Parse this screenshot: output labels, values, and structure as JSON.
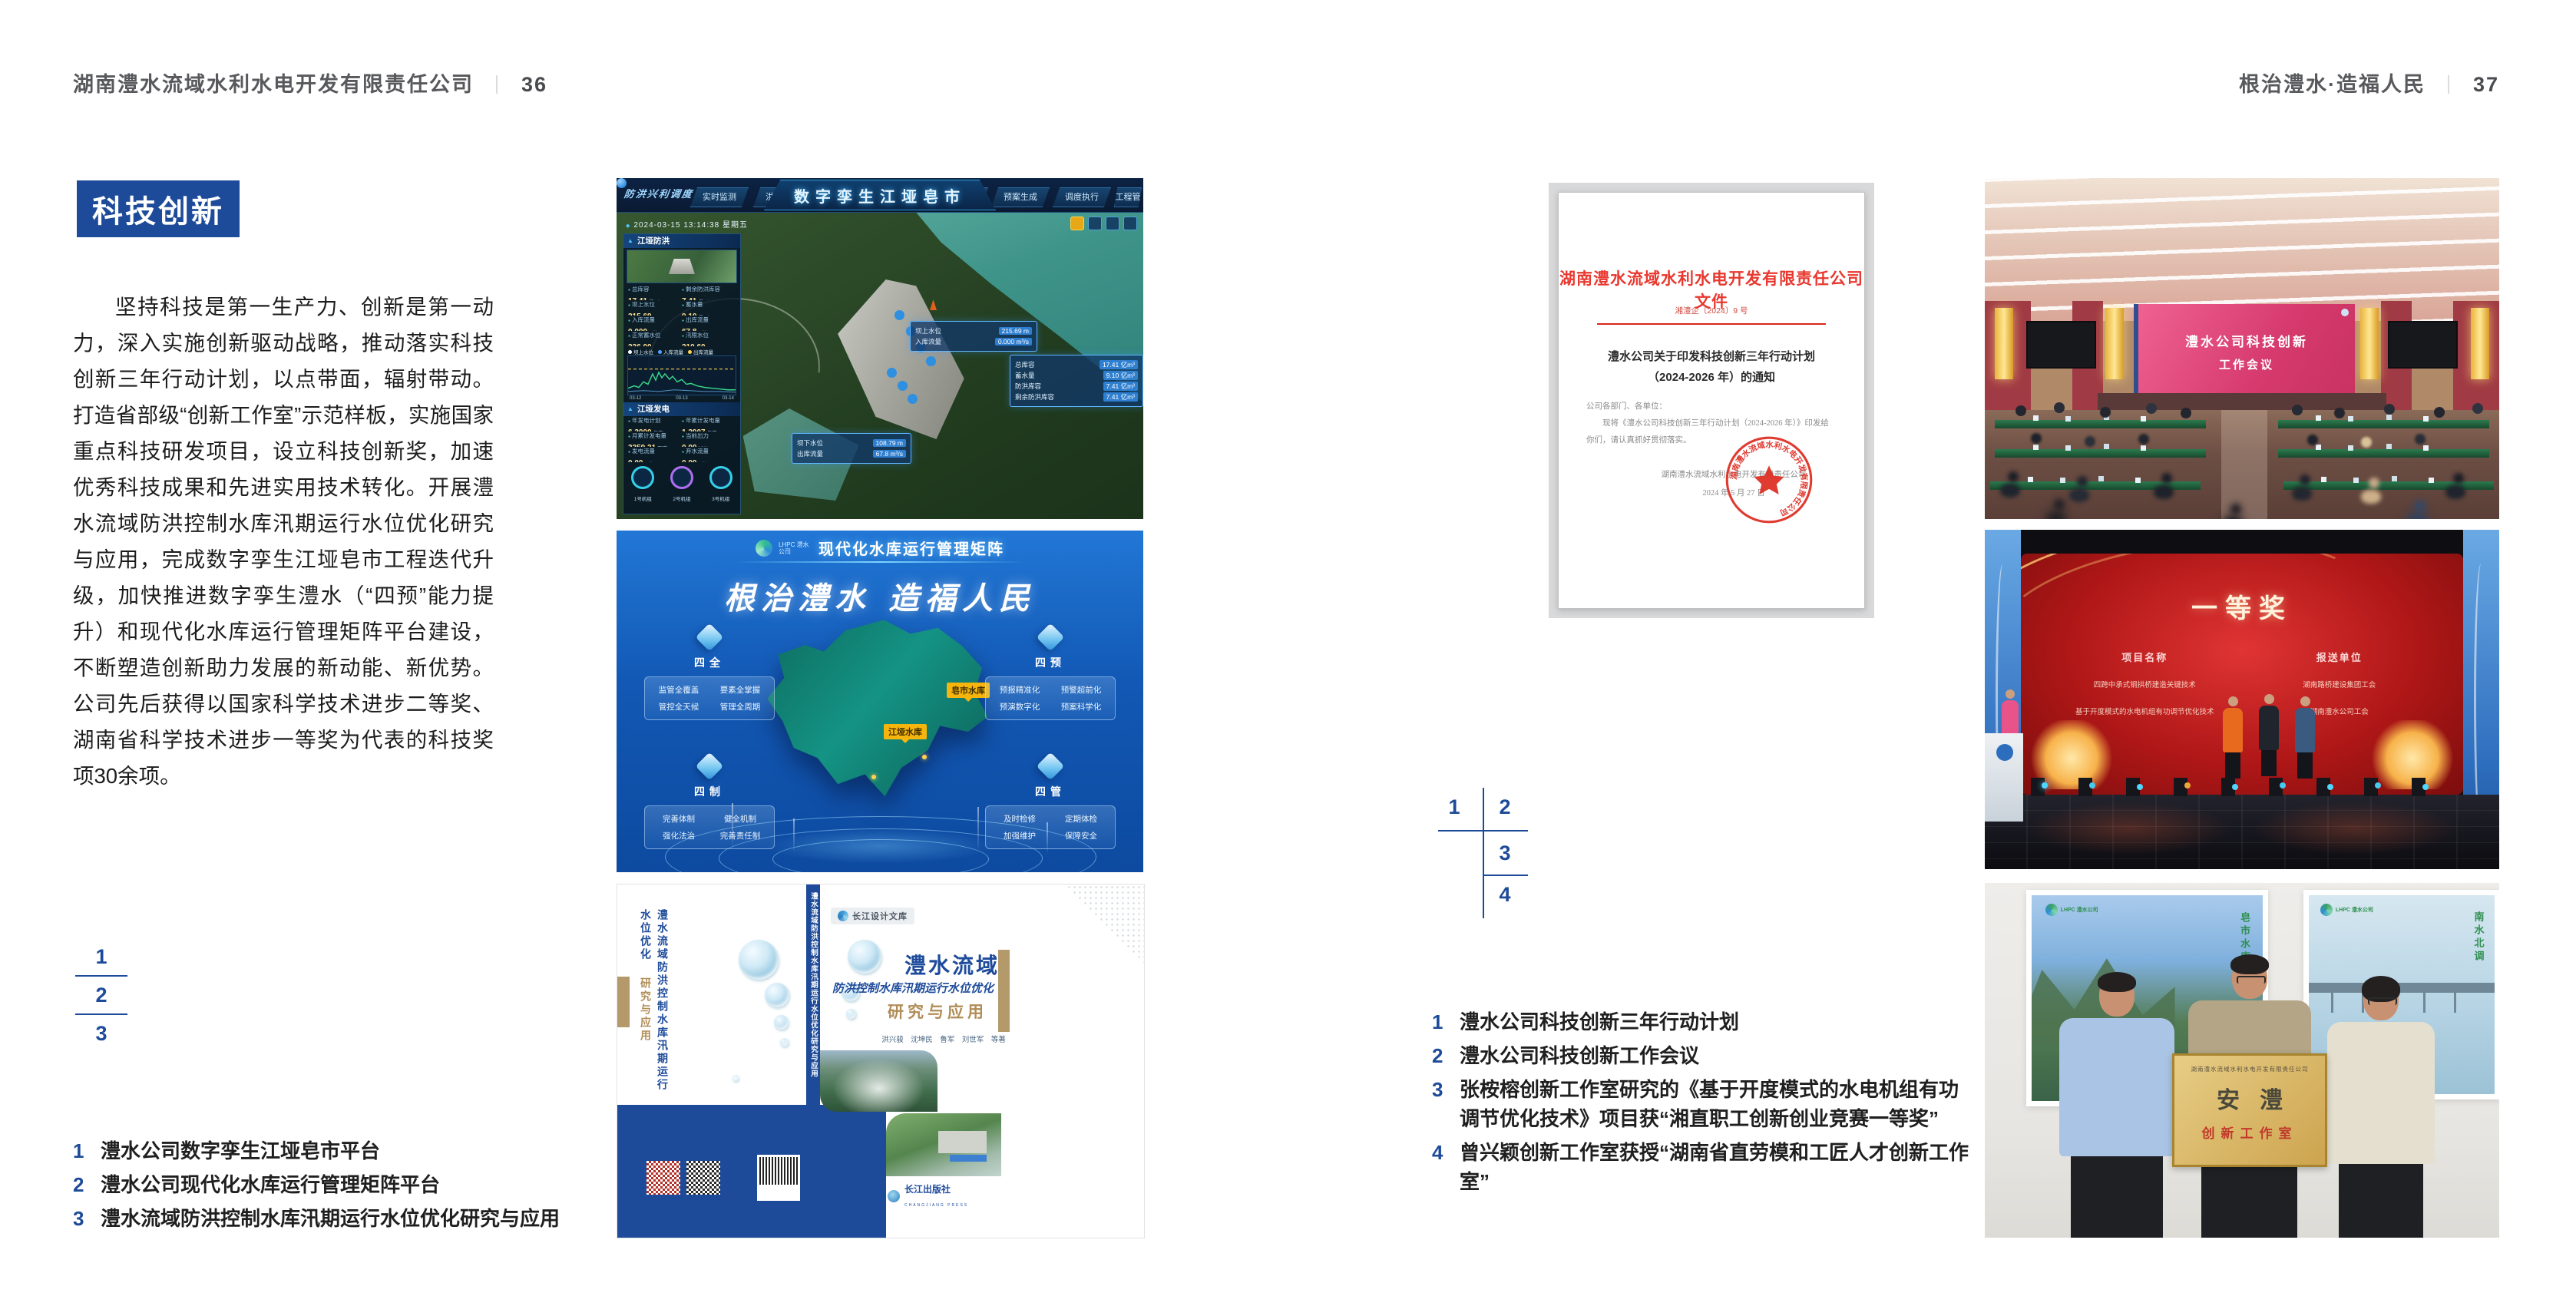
{
  "left_page": {
    "header": {
      "company": "湖南澧水流域水利水电开发有限责任公司",
      "divider": "｜",
      "page_no": "36"
    },
    "section_title": "科技创新",
    "body": "坚持科技是第一生产力、创新是第一动力，深入实施创新驱动战略，推动落实科技创新三年行动计划，以点带面，辐射带动。打造省部级“创新工作室”示范样板，实施国家重点科技研发项目，设立科技创新奖，加速优秀科技成果和先进实用技术转化。开展澧水流域防洪控制水库汛期运行水位优化研究与应用，完成数字孪生江垭皂市工程迭代升级，加快推进数字孪生澧水（“四预”能力提升）和现代化水库运行管理矩阵平台建设，不断塑造创新助力发展的新动能、新优势。公司先后获得以国家科学技术进步二等奖、湖南省科学技术进步一等奖为代表的科技奖项30余项。",
    "figure_nums": [
      "1",
      "2",
      "3"
    ],
    "captions": [
      {
        "no": "1",
        "text": "澧水公司数字孪生江垭皂市平台"
      },
      {
        "no": "2",
        "text": "澧水公司现代化水库运行管理矩阵平台"
      },
      {
        "no": "3",
        "text": "澧水流域防洪控制水库汛期运行水位优化研究与应用"
      }
    ]
  },
  "right_page": {
    "header": {
      "slogan": "根治澧水·造福人民",
      "divider": "｜",
      "page_no": "37"
    },
    "figure_nums": [
      "1",
      "2",
      "3",
      "4"
    ],
    "captions": [
      {
        "no": "1",
        "text": "澧水公司科技创新三年行动计划"
      },
      {
        "no": "2",
        "text": "澧水公司科技创新工作会议"
      },
      {
        "no": "3",
        "text": "张桉榕创新工作室研究的《基于开度模式的水电机组有功调节优化技术》项目获“湘直职工创新创业竞赛一等奖”"
      },
      {
        "no": "4",
        "text": "曾兴颖创新工作室获授“湖南省直劳模和工匠人才创新工作室”"
      }
    ]
  },
  "dashboard1": {
    "menu_label": "防洪兴利调度",
    "title": "数字孪生江垭皂市",
    "tabs_left": [
      "实时监测",
      "洪水预报",
      "防洪预警"
    ],
    "tabs_right": [
      "风险预测",
      "预案生成",
      "调度执行",
      "工程管理"
    ],
    "timestamp": "2024-03-15 13:14:38 星期五",
    "panel1": {
      "title": "江垭防洪",
      "stats": [
        {
          "label": "总库容",
          "value": "17.41",
          "unit": "亿m³"
        },
        {
          "label": "剩余防洪库容",
          "value": "7.41",
          "unit": "亿m³"
        },
        {
          "label": "坝上水位",
          "value": "215.69",
          "unit": "m"
        },
        {
          "label": "蓄水量",
          "value": "9.10",
          "unit": "亿m³"
        },
        {
          "label": "入库流量",
          "value": "0.000",
          "unit": "m³/s"
        },
        {
          "label": "出库流量",
          "value": "67.8",
          "unit": "m³/s"
        },
        {
          "label": "正常蓄水位",
          "value": "236.00",
          "unit": "m"
        },
        {
          "label": "汛限水位",
          "value": "210.60",
          "unit": "m"
        }
      ],
      "legend": [
        "坝上水位",
        "入库流量",
        "出库流量"
      ],
      "x_ticks": [
        "03-12",
        "03-13",
        "03-14"
      ]
    },
    "panel2": {
      "title": "江垭发电",
      "stats": [
        {
          "label": "年发电计划",
          "value": "6.3000",
          "unit": "亿度"
        },
        {
          "label": "年累计发电量",
          "value": "1.2907",
          "unit": "亿度"
        },
        {
          "label": "月累计发电量",
          "value": "3359.21",
          "unit": "万度"
        },
        {
          "label": "当前出力",
          "value": "0.00",
          "unit": "MW"
        },
        {
          "label": "发电流量",
          "value": "0.00",
          "unit": "m³/s"
        },
        {
          "label": "弃水流量",
          "value": "0.00",
          "unit": "m³/s"
        }
      ],
      "gauges": [
        "1号机组",
        "2号机组",
        "3号机组"
      ]
    },
    "tooltip1": [
      {
        "label": "坝上水位",
        "value": "215.69 m"
      },
      {
        "label": "入库流量",
        "value": "0.000 m³/s"
      }
    ],
    "tooltip2": [
      {
        "label": "总库容",
        "value": "17.41 亿m³"
      },
      {
        "label": "蓄水量",
        "value": "9.10 亿m³"
      },
      {
        "label": "防洪库容",
        "value": "7.41 亿m³"
      },
      {
        "label": "剩余防洪库容",
        "value": "7.41 亿m³"
      }
    ],
    "tooltip3": [
      {
        "label": "坝下水位",
        "value": "108.79 m"
      },
      {
        "label": "出库流量",
        "value": "67.8 m³/s"
      }
    ]
  },
  "dashboard2": {
    "logo_text": "LHPC 澧水公司",
    "title": "现代化水库运行管理矩阵",
    "slogan": "根治澧水 造福人民",
    "panels": [
      {
        "title": "四全",
        "items": [
          "监管全覆盖",
          "要素全掌握",
          "管控全天候",
          "管理全周期"
        ]
      },
      {
        "title": "四预",
        "items": [
          "预报精准化",
          "预警超前化",
          "预演数字化",
          "预案科学化"
        ]
      },
      {
        "title": "四制",
        "items": [
          "完善体制",
          "健全机制",
          "强化法治",
          "完善责任制"
        ]
      },
      {
        "title": "四管",
        "items": [
          "及时检修",
          "定期体检",
          "加强维护",
          "保障安全"
        ]
      }
    ],
    "map_labels": [
      "皂市水库",
      "江垭水库"
    ]
  },
  "book": {
    "series": "长江设计文库",
    "title": "澧水流域",
    "subtitle": "防洪控制水库汛期运行水位优化",
    "subtitle2": "研究与应用",
    "authors": "洪兴骏　沈坤民　鲁军　刘世军　等著",
    "publisher": "长江出版社",
    "publisher_en": "CHANGJIANG PRESS",
    "spine": "澧水流域防洪控制水库汛期运行水位优化研究与应用",
    "back_title": "澧水流域防洪控制水库汛期运行水位优化",
    "back_title2": "研究与应用"
  },
  "document": {
    "header": "湖南澧水流域水利水电开发有限责任公司文件",
    "doc_no": "湘澧企〔2024〕9 号",
    "title_line1": "澧水公司关于印发科技创新三年行动计划",
    "title_line2": "（2024-2026 年）的通知",
    "salutation": "公司各部门、各单位：",
    "body": "现将《澧水公司科技创新三年行动计划（2024-2026 年）》印发给你们，请认真抓好贯彻落实。",
    "signer": "湖南澧水流域水利水电开发有限责任公司",
    "date": "2024 年 5 月 27 日",
    "seal_text": "湖南澧水流域水利水电开发有限责任公司"
  },
  "meeting": {
    "screen_line1": "澧水公司科技创新",
    "screen_line2": "工作会议"
  },
  "award": {
    "title": "一等奖",
    "col1": "项目名称",
    "col2": "报送单位",
    "rows": [
      {
        "project": "四跨中承式钢拱桥建造关键技术",
        "org": "湖南路桥建设集团工会"
      },
      {
        "project": "基于开度模式的水电机组有功调节优化技术",
        "org": "湖南澧水公司工会"
      }
    ]
  },
  "plaque": {
    "poster_logo": "LHPC 澧水公司",
    "poster_left_text": "皂市水库",
    "poster_right_text": "南水北调",
    "top_line": "湖南澧水流域水利水电开发有限责任公司",
    "main": "安澧",
    "sub": "创新工作室"
  }
}
